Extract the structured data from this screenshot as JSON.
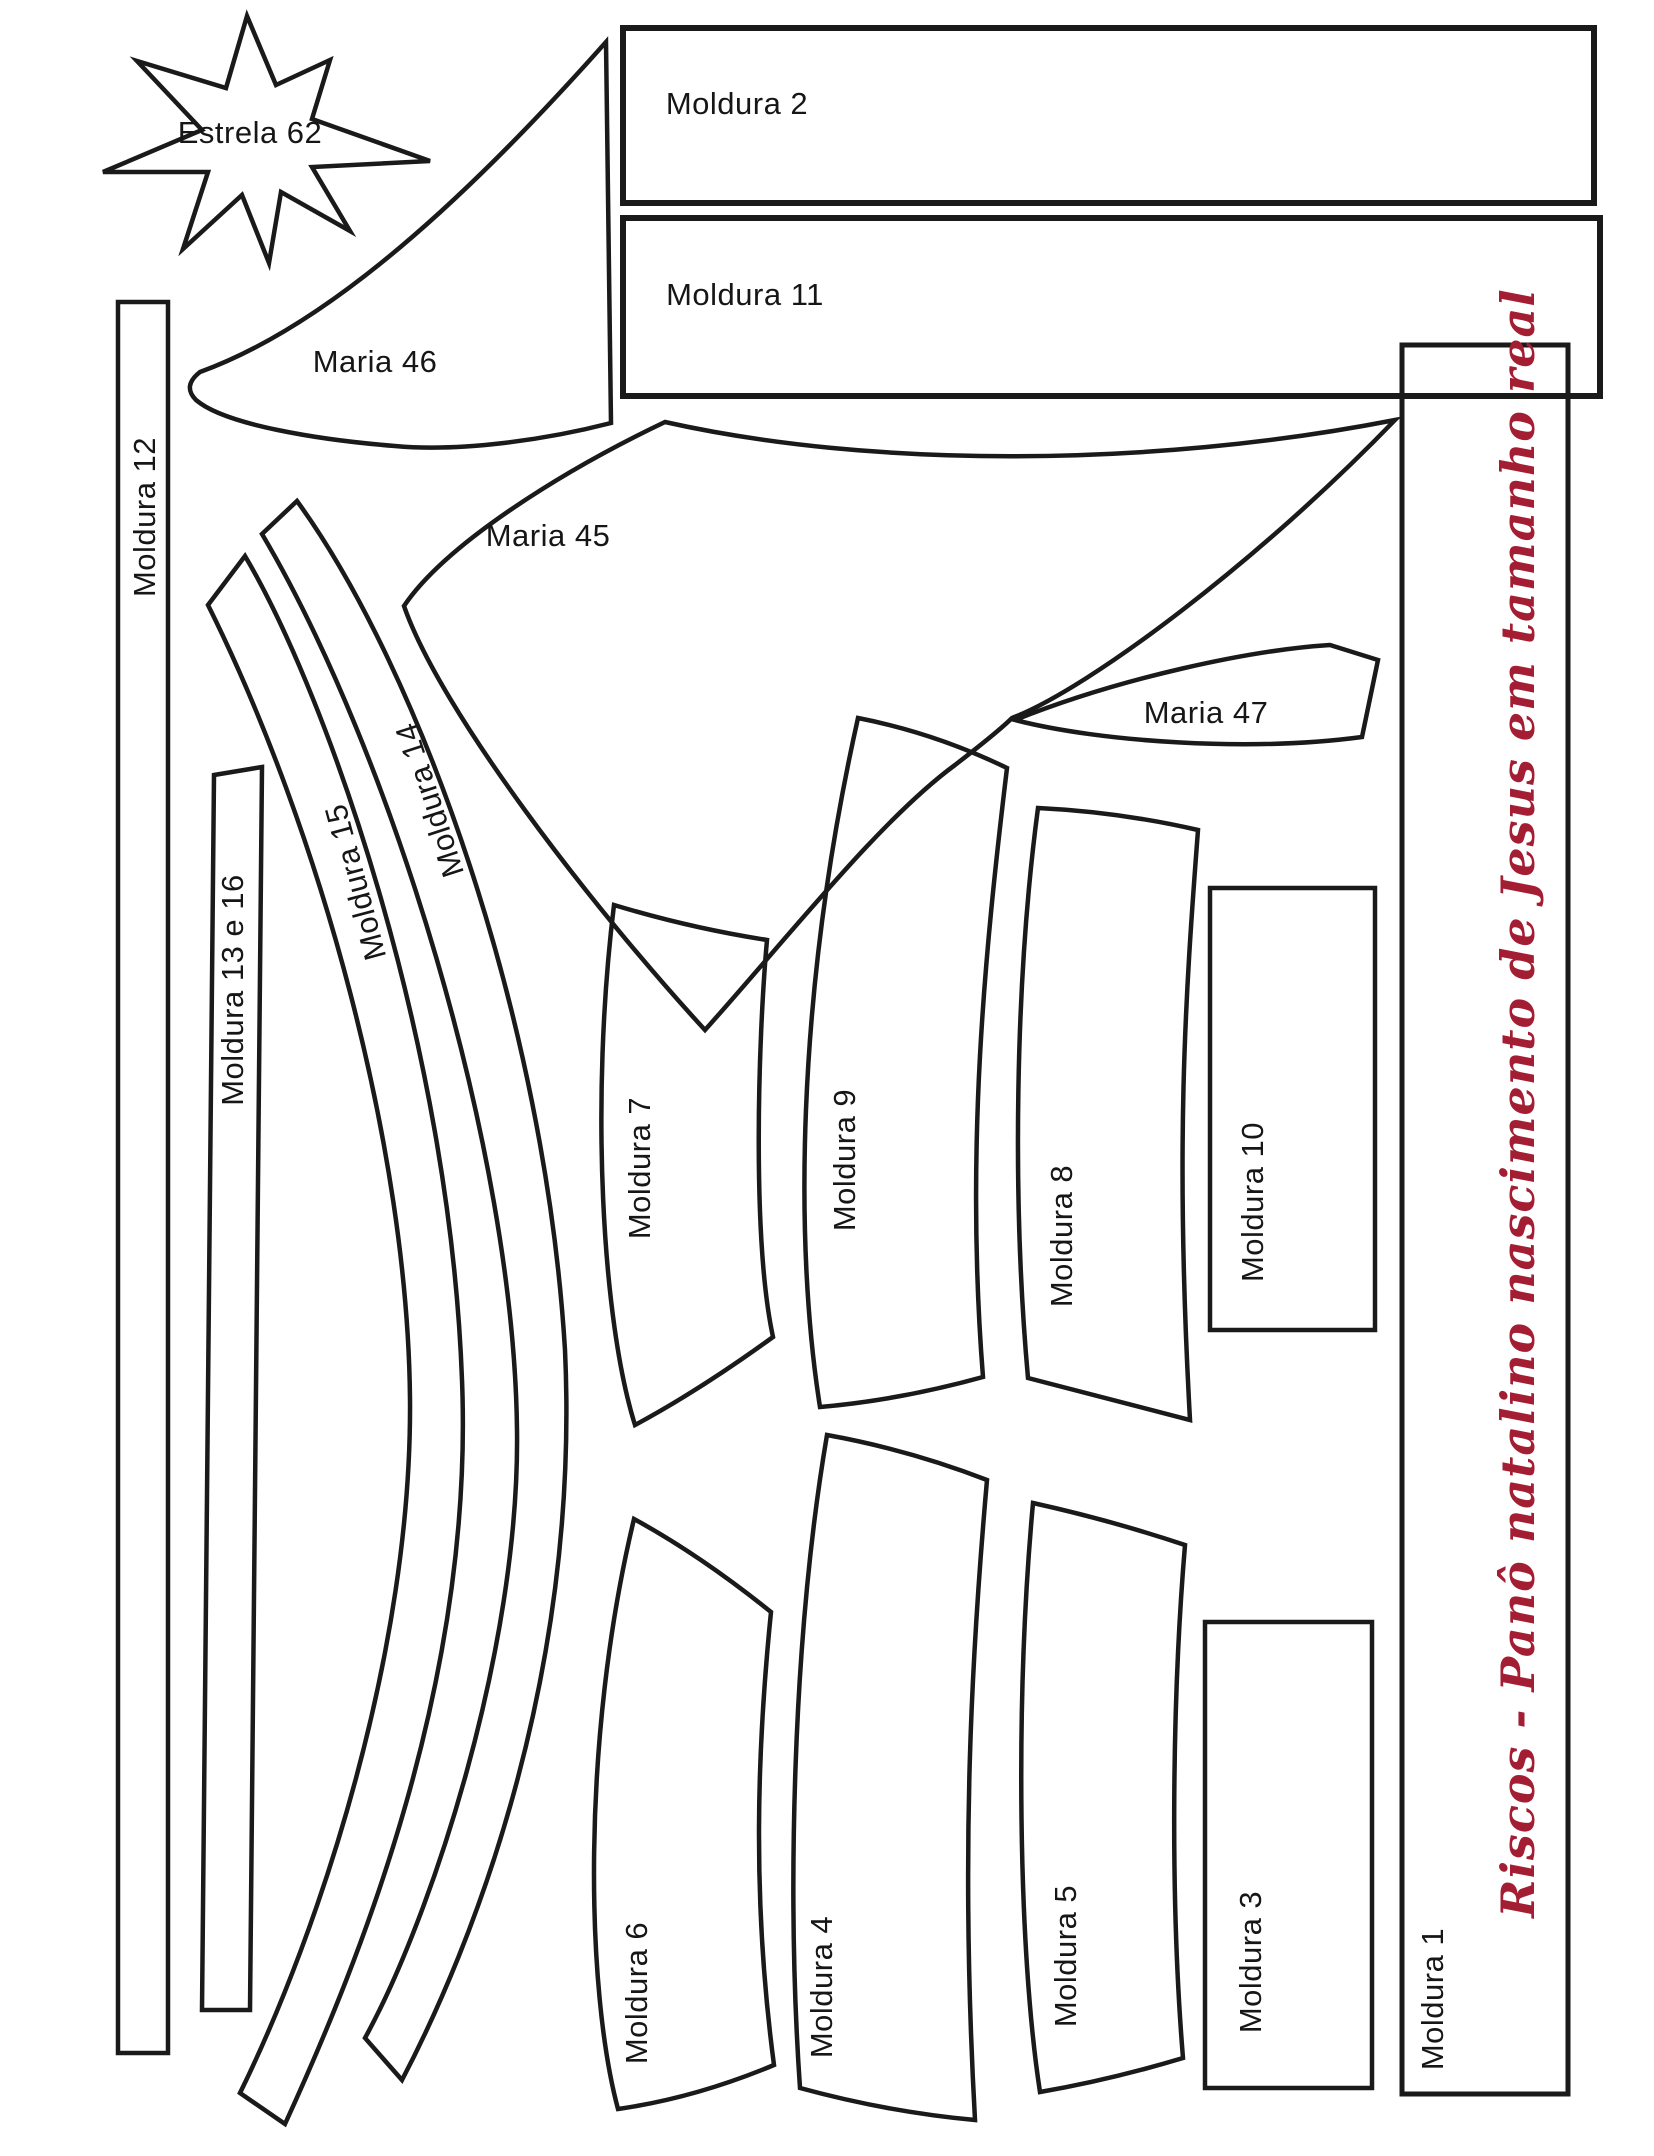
{
  "page": {
    "background": "#ffffff",
    "ink_color": "#1a1a1a",
    "accent_color": "#a41e33"
  },
  "title": {
    "text": "Riscos - Panô natalino nascimento de Jesus em tamanho real"
  },
  "pieces": [
    {
      "id": "estrela-62",
      "label": "Estrela 62"
    },
    {
      "id": "moldura-2",
      "label": "Moldura 2"
    },
    {
      "id": "moldura-11",
      "label": "Moldura 11"
    },
    {
      "id": "maria-46",
      "label": "Maria 46"
    },
    {
      "id": "maria-45",
      "label": "Maria 45"
    },
    {
      "id": "maria-47",
      "label": "Maria 47"
    },
    {
      "id": "moldura-12",
      "label": "Moldura 12"
    },
    {
      "id": "moldura-13-16",
      "label": "Moldura 13 e 16"
    },
    {
      "id": "moldura-15",
      "label": "Moldura 15"
    },
    {
      "id": "moldura-14",
      "label": "Moldura 14"
    },
    {
      "id": "moldura-7",
      "label": "Moldura 7"
    },
    {
      "id": "moldura-9",
      "label": "Moldura 9"
    },
    {
      "id": "moldura-8",
      "label": "Moldura 8"
    },
    {
      "id": "moldura-10",
      "label": "Moldura 10"
    },
    {
      "id": "moldura-6",
      "label": "Moldura 6"
    },
    {
      "id": "moldura-4",
      "label": "Moldura 4"
    },
    {
      "id": "moldura-5",
      "label": "Moldura 5"
    },
    {
      "id": "moldura-3",
      "label": "Moldura 3"
    },
    {
      "id": "moldura-1",
      "label": "Moldura 1"
    }
  ]
}
